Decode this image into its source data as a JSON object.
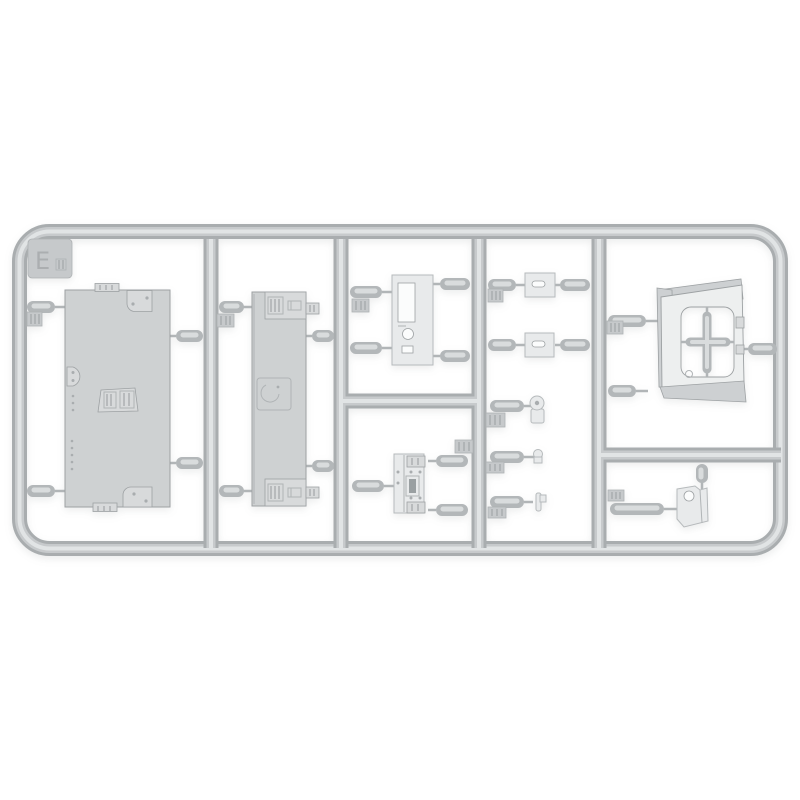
{
  "sprue": {
    "letter": "E",
    "material": "grey styrene"
  },
  "colors": {
    "bg": "#ffffff",
    "tube_edge": "#a9adaf",
    "tube_mid": "#c7cacc",
    "tube_hi": "#e1e4e5",
    "gate_base": "#b3b7b9",
    "gate_hi": "#d9dcdd",
    "pin": "#b1b5b7",
    "panel_fill": "#ced1d2",
    "panel_raised": "#d8dadb",
    "panel_edge": "#9da1a3",
    "panel_detail": "#b0b4b6",
    "light_part_fill": "#e8eaeb",
    "light_part_edge": "#b6babc",
    "part5_face": "#edefef",
    "part5_side": "#cdd0d2",
    "hole_fill": "#fbfcfc",
    "slot_fill": "#9aa0a2",
    "dot": "#a9adaf",
    "tag_fill": "#c6c9cb",
    "tag_edge": "#aeb2b4",
    "tag_ridge": "#a2a6a8"
  }
}
